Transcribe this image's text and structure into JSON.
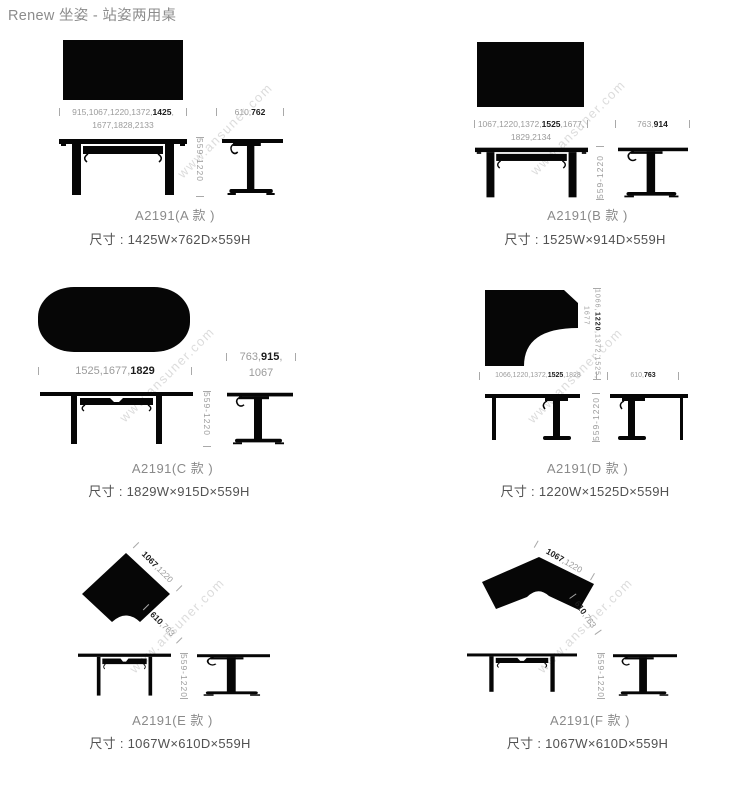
{
  "page": {
    "title": "Renew 坐姿 - 站姿两用桌",
    "watermark": "www.ansuner.com"
  },
  "colors": {
    "ink": "#060606",
    "dim_text": "#9b9b9b",
    "dim_bold": "#1c1c1c",
    "label": "#8a8a8a",
    "size_text": "#525252",
    "watermark": "#dcdcdc"
  },
  "panels": {
    "a": {
      "name": "A2191(A 款 )",
      "size": "尺寸 : 1425W×762D×559H",
      "width_line1": {
        "pre": "915,1067,1220,1372,",
        "bold": "1425",
        "post": ","
      },
      "width_line2": "1677,1828,2133",
      "depth": {
        "pre": "610,",
        "bold": "762",
        "post": ""
      },
      "height": "559-1220"
    },
    "b": {
      "name": "A2191(B 款 )",
      "size": "尺寸 : 1525W×914D×559H",
      "width_line1": {
        "pre": "1067,1220,1372,",
        "bold": "1525",
        "post": ",1677,"
      },
      "width_line2": "1829,2134",
      "depth": {
        "pre": "763,",
        "bold": "914",
        "post": ""
      },
      "height": "559-1220"
    },
    "c": {
      "name": "A2191(C 款 )",
      "size": "尺寸 : 1829W×915D×559H",
      "width_line1": {
        "pre": "1525,1677,",
        "bold": "1829",
        "post": ""
      },
      "depth_line1": {
        "pre": "763,",
        "bold": "915",
        "post": ","
      },
      "depth_line2": "1067",
      "height": "559-1220"
    },
    "d": {
      "name": "A2191(D 款 )",
      "size": "尺寸 : 1220W×1525D×559H",
      "side_line1": {
        "pre": "1066,",
        "bold": "1220",
        "post": ",1372,1525,"
      },
      "side_line2": "1677",
      "width_line1": {
        "pre": "1066,1220,1372,",
        "bold": "1525",
        "post": ",1828"
      },
      "depth": {
        "pre": "610,",
        "bold": "763",
        "post": ""
      },
      "height": "559-1220"
    },
    "e": {
      "name": "A2191(E 款 )",
      "size": "尺寸 : 1067W×610D×559H",
      "diag1": {
        "pre": "",
        "bold": "1067",
        "post": ",1220"
      },
      "diag2": {
        "pre": "",
        "bold": "610",
        "post": ",763"
      },
      "height": "559-1220"
    },
    "f": {
      "name": "A2191(F 款 )",
      "size": "尺寸 : 1067W×610D×559H",
      "diag1": {
        "pre": "",
        "bold": "1067",
        "post": ",1220"
      },
      "diag2": {
        "pre": "",
        "bold": "610",
        "post": ",763"
      },
      "height": "559-1220"
    }
  }
}
